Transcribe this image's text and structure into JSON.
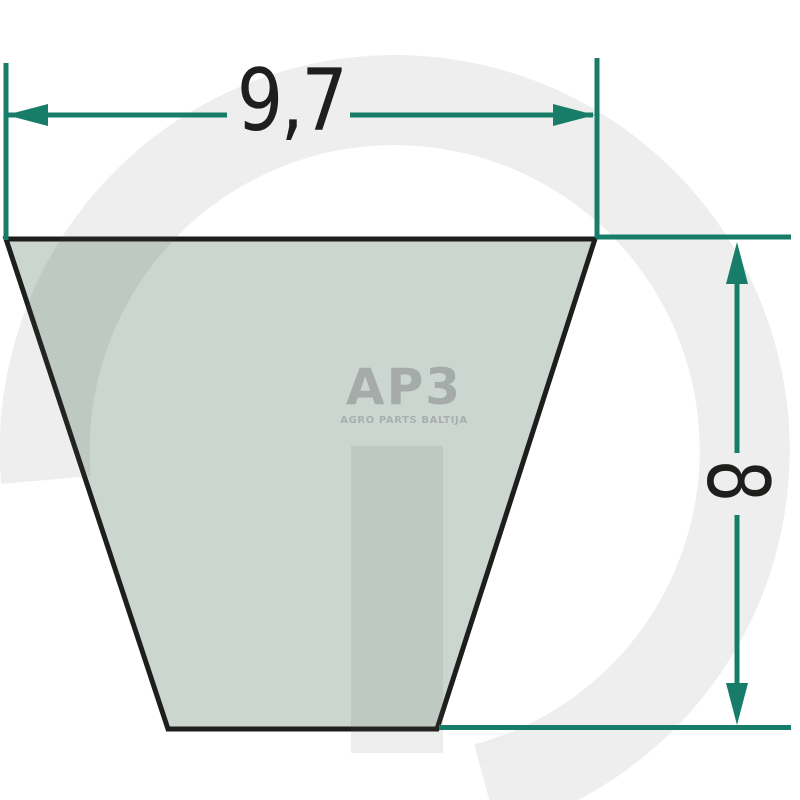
{
  "diagram": {
    "description": "V-belt cross-section technical drawing with dimensions",
    "dimensions": {
      "width": {
        "value": "9,7"
      },
      "height": {
        "value": "8"
      }
    }
  },
  "logo": {
    "text": "AP3",
    "subtitle": "AGRO PARTS BALTIJA"
  },
  "watermark": {
    "letter": "G"
  },
  "colors": {
    "teal": "#177d69",
    "ink": "#1e1e1c",
    "belt_fill": "#ccd6d1",
    "belt_outline": "#1e1e1c",
    "watermark_gray": "#566059",
    "logo_gray": "#a4aba8",
    "logo_subtitle_gray": "#a8afac",
    "background": "#ffffff"
  }
}
